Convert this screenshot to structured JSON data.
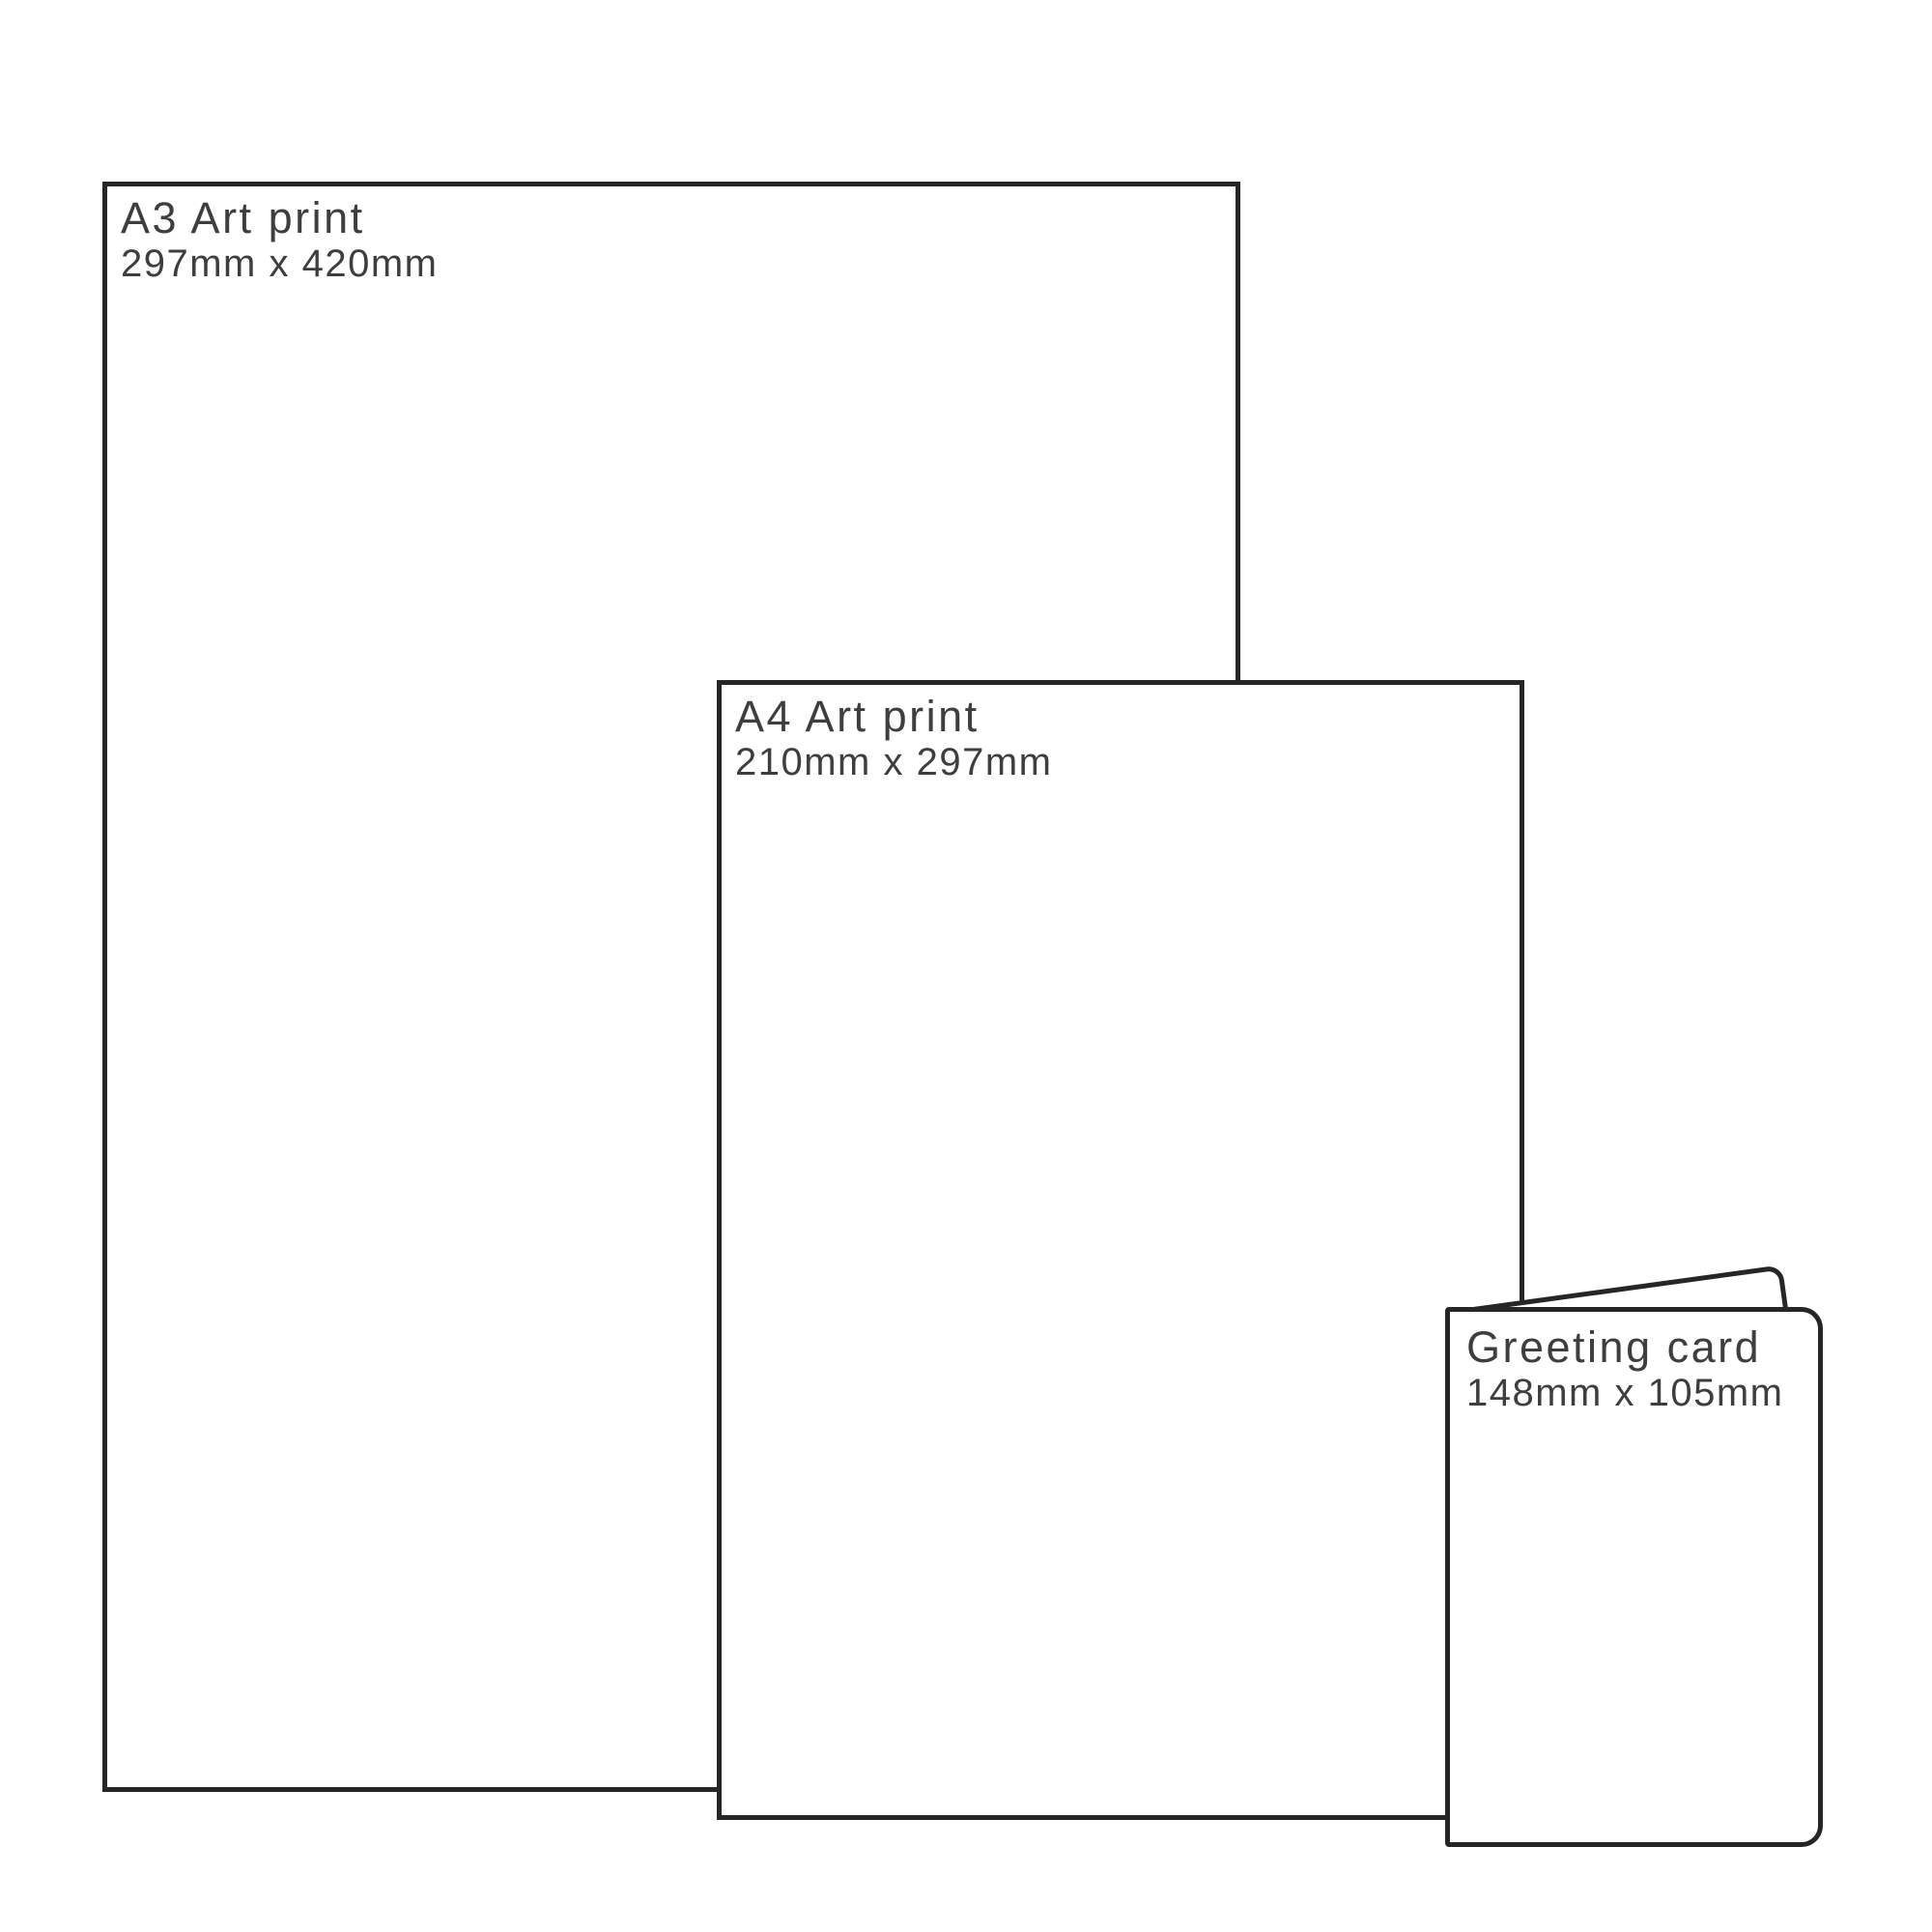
{
  "diagram": {
    "type": "print-size-comparison",
    "background_color": "#ffffff",
    "line_color": "#262626",
    "text_color": "#3e3e3e"
  },
  "items": [
    {
      "id": "a3-art-print",
      "title": "A3 Art print",
      "dimensions": "297mm x 420mm"
    },
    {
      "id": "a4-art-print",
      "title": "A4 Art print",
      "dimensions": "210mm x 297mm"
    },
    {
      "id": "greeting-card",
      "title": "Greeting card",
      "dimensions": "148mm x 105mm"
    }
  ]
}
